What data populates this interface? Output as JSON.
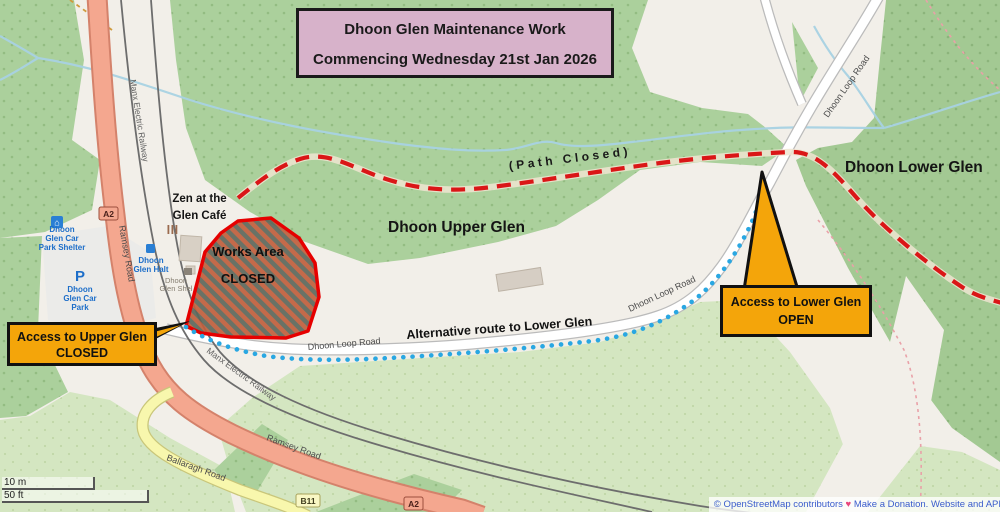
{
  "title": {
    "line1": "Dhoon Glen Maintenance Work",
    "line2": "Commencing Wednesday 21st Jan 2026"
  },
  "callouts": {
    "upper": {
      "line1": "Access to Upper Glen",
      "line2": "CLOSED"
    },
    "lower": {
      "line1": "Access to Lower Glen",
      "line2": "OPEN"
    }
  },
  "annotations": {
    "path_closed": "(Path Closed)",
    "alt_route": "Alternative route to Lower Glen",
    "works_line1": "Works Area",
    "works_line2": "CLOSED"
  },
  "areas": {
    "upper_glen": "Dhoon Upper Glen",
    "lower_glen": "Dhoon Lower Glen"
  },
  "pois": {
    "cafe": {
      "line1": "Zen at the",
      "line2": "Glen Café"
    },
    "car_park_shelter": {
      "line1": "Dhoon",
      "line2": "Glen Car",
      "line3": "Park Shelter"
    },
    "car_park": {
      "symbol": "P",
      "line1": "Dhoon",
      "line2": "Glen Car",
      "line3": "Park"
    },
    "halt": {
      "line1": "Dhoon",
      "line2": "Glen Halt"
    },
    "glen_shelter": {
      "line1": "Dhoon",
      "line2": "Glen Shel"
    }
  },
  "roads": {
    "a2_badge": "A2",
    "b11_badge": "B11",
    "ramsey": "Ramsey Road",
    "ballaragh": "Ballaragh Road",
    "dhoon_loop": "Dhoon Loop Road",
    "railway": "Manx Electric Railway"
  },
  "scale": {
    "metric": "10 m",
    "imperial": "50 ft"
  },
  "attribution": {
    "copyright": "© OpenStreetMap contributors",
    "heart": "♥",
    "donation": "Make a Donation.",
    "website": "Website and API"
  },
  "colors": {
    "closure_red": "#da1617",
    "route_blue": "#29a7e2",
    "callout_orange": "#f4a50a",
    "title_pink": "#d7b2ca",
    "forest_green": "#abd09c",
    "meadow_green": "#d4e6c1",
    "trunk_road": "#f4a78f",
    "secondary_road": "#f8f7ad",
    "stream_blue": "#a8d2e3"
  }
}
